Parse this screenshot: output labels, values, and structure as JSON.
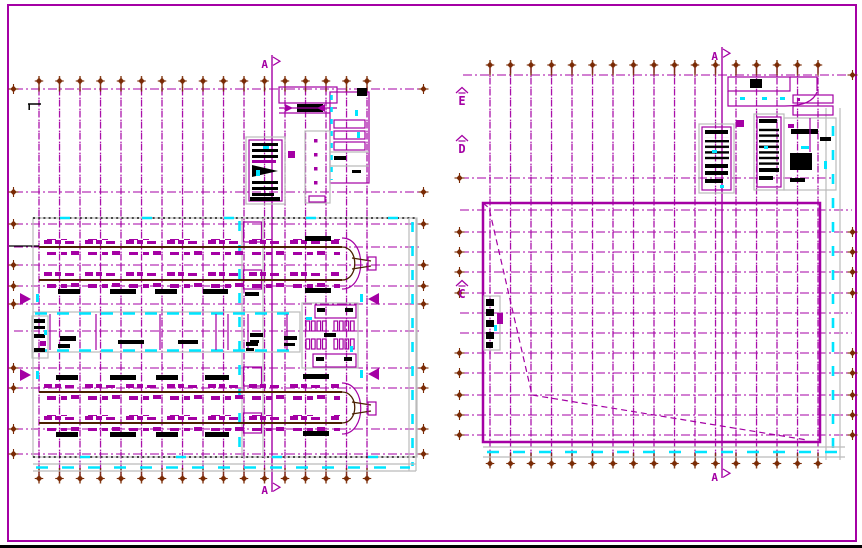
{
  "sheet": {
    "background": "#ffffff",
    "frame_color": "#a400a4",
    "bottom_edge_color": "#000000"
  },
  "palette": {
    "grid_magenta": "#a400a4",
    "accent_cyan": "#00e5ff",
    "axis_marker_brown": "#7a2b05",
    "conveyor_dark": "#4a2000",
    "outline_gray": "#bbbbbb",
    "annotation_black": "#000000"
  },
  "labels": {
    "section": "A",
    "elev_top": "E",
    "elev_mid": "D",
    "elev_bottom": "C"
  },
  "left_plan": {
    "grid_column_markers_top": 17,
    "grid_column_markers_bottom": 17,
    "horizontal_grid_lines": 12,
    "conveyor_lines": 4,
    "entrance_arrows": 4,
    "section_cut_label": "A"
  },
  "right_plan": {
    "grid_column_markers_top": 17,
    "grid_column_markers_bottom": 17,
    "horizontal_grid_lines": 14,
    "elevation_marks": [
      "E",
      "D",
      "C"
    ],
    "section_cut_label": "A"
  }
}
